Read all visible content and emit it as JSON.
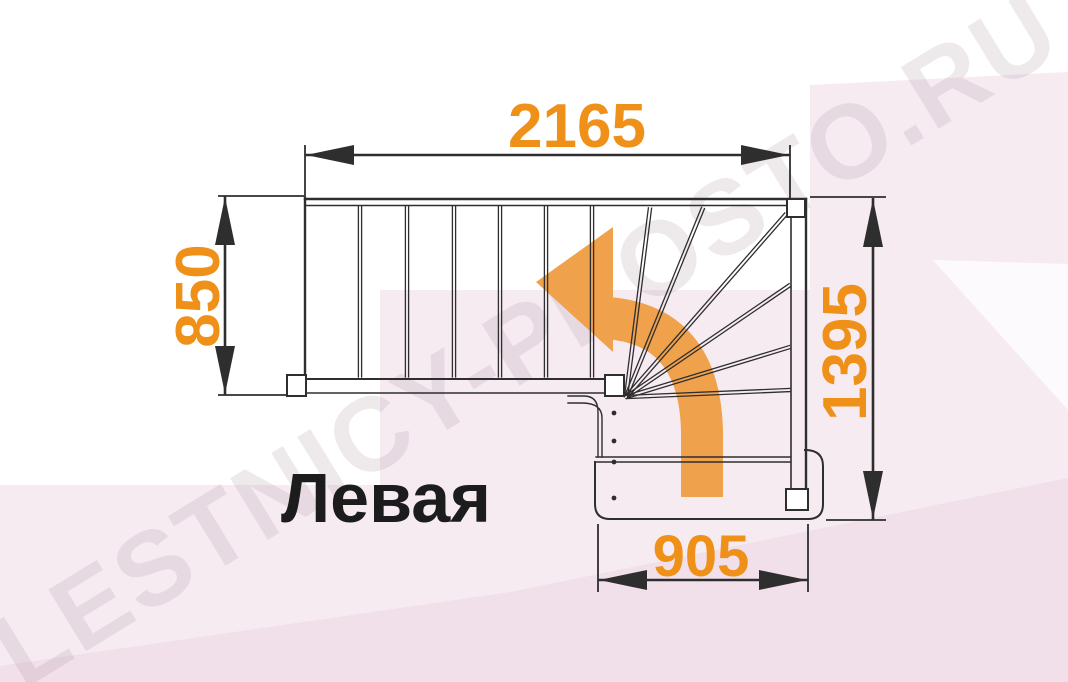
{
  "drawing": {
    "label": "Левая",
    "watermark": "LESTNICY-PROSTO.RU",
    "dimensions": {
      "top": "2165",
      "left": "850",
      "right": "1395",
      "bottom": "905"
    },
    "colors": {
      "dimension_text": "#ef9019",
      "direction_arrow": "#f0a14c",
      "line": "#2e2e2e",
      "label_text": "#1c1c1c",
      "canvas": "#ffffff",
      "facet_pink": "#f7ebf2",
      "facet_pink_deep": "#f1e0ea",
      "facet_white": "#fdfafd",
      "watermark_tint": "#8a6f80"
    }
  }
}
